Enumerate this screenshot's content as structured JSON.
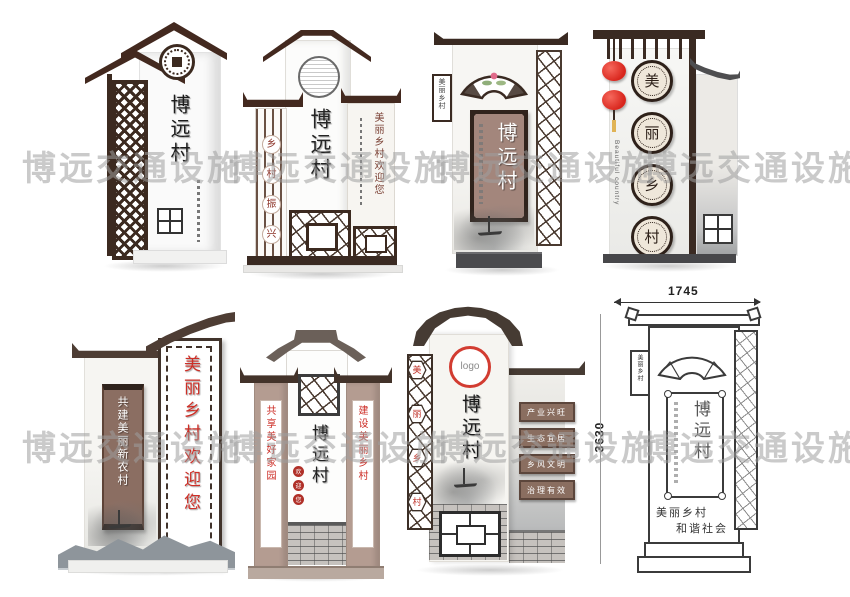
{
  "watermark": {
    "text": "博远交通设施",
    "color": "#9e9e9e"
  },
  "colors": {
    "roof_dark_brown": "#43291f",
    "roof_gray": "#6b6059",
    "plaque_brown": "#8a6e60",
    "accent_red": "#d23c31",
    "calligraphy_red": "#ce2f27"
  },
  "signs": {
    "s1": {
      "village": "博远村"
    },
    "s2": {
      "village": "博远村",
      "circle_chars": [
        "乡",
        "村",
        "振",
        "兴"
      ],
      "welcome": "美丽乡村欢迎您"
    },
    "s3": {
      "village": "博远村",
      "tab": "美丽乡村"
    },
    "s4": {
      "medallion_chars": [
        "美",
        "丽",
        "乡",
        "村"
      ],
      "side_text": "Beautiful country"
    },
    "s5": {
      "plaque": "共建美丽新农村",
      "welcome": "美丽乡村欢迎您"
    },
    "s6": {
      "village": "博远村",
      "seal_chars": [
        "欢",
        "迎",
        "您"
      ],
      "left_plaque": "共享美好家园",
      "right_plaque": "建设美丽乡村"
    },
    "s7": {
      "logo": "logo",
      "village": "博远村",
      "hex_chars": [
        "美",
        "丽",
        "乡",
        "村"
      ],
      "boards": [
        "产业兴旺",
        "生态宜居",
        "乡风文明",
        "治理有效"
      ]
    },
    "s8": {
      "width_dim": "1745",
      "height_dim": "3630",
      "village": "博远村",
      "tab": "美丽乡村",
      "captions": [
        "美丽乡村",
        "和谐社会"
      ]
    }
  }
}
